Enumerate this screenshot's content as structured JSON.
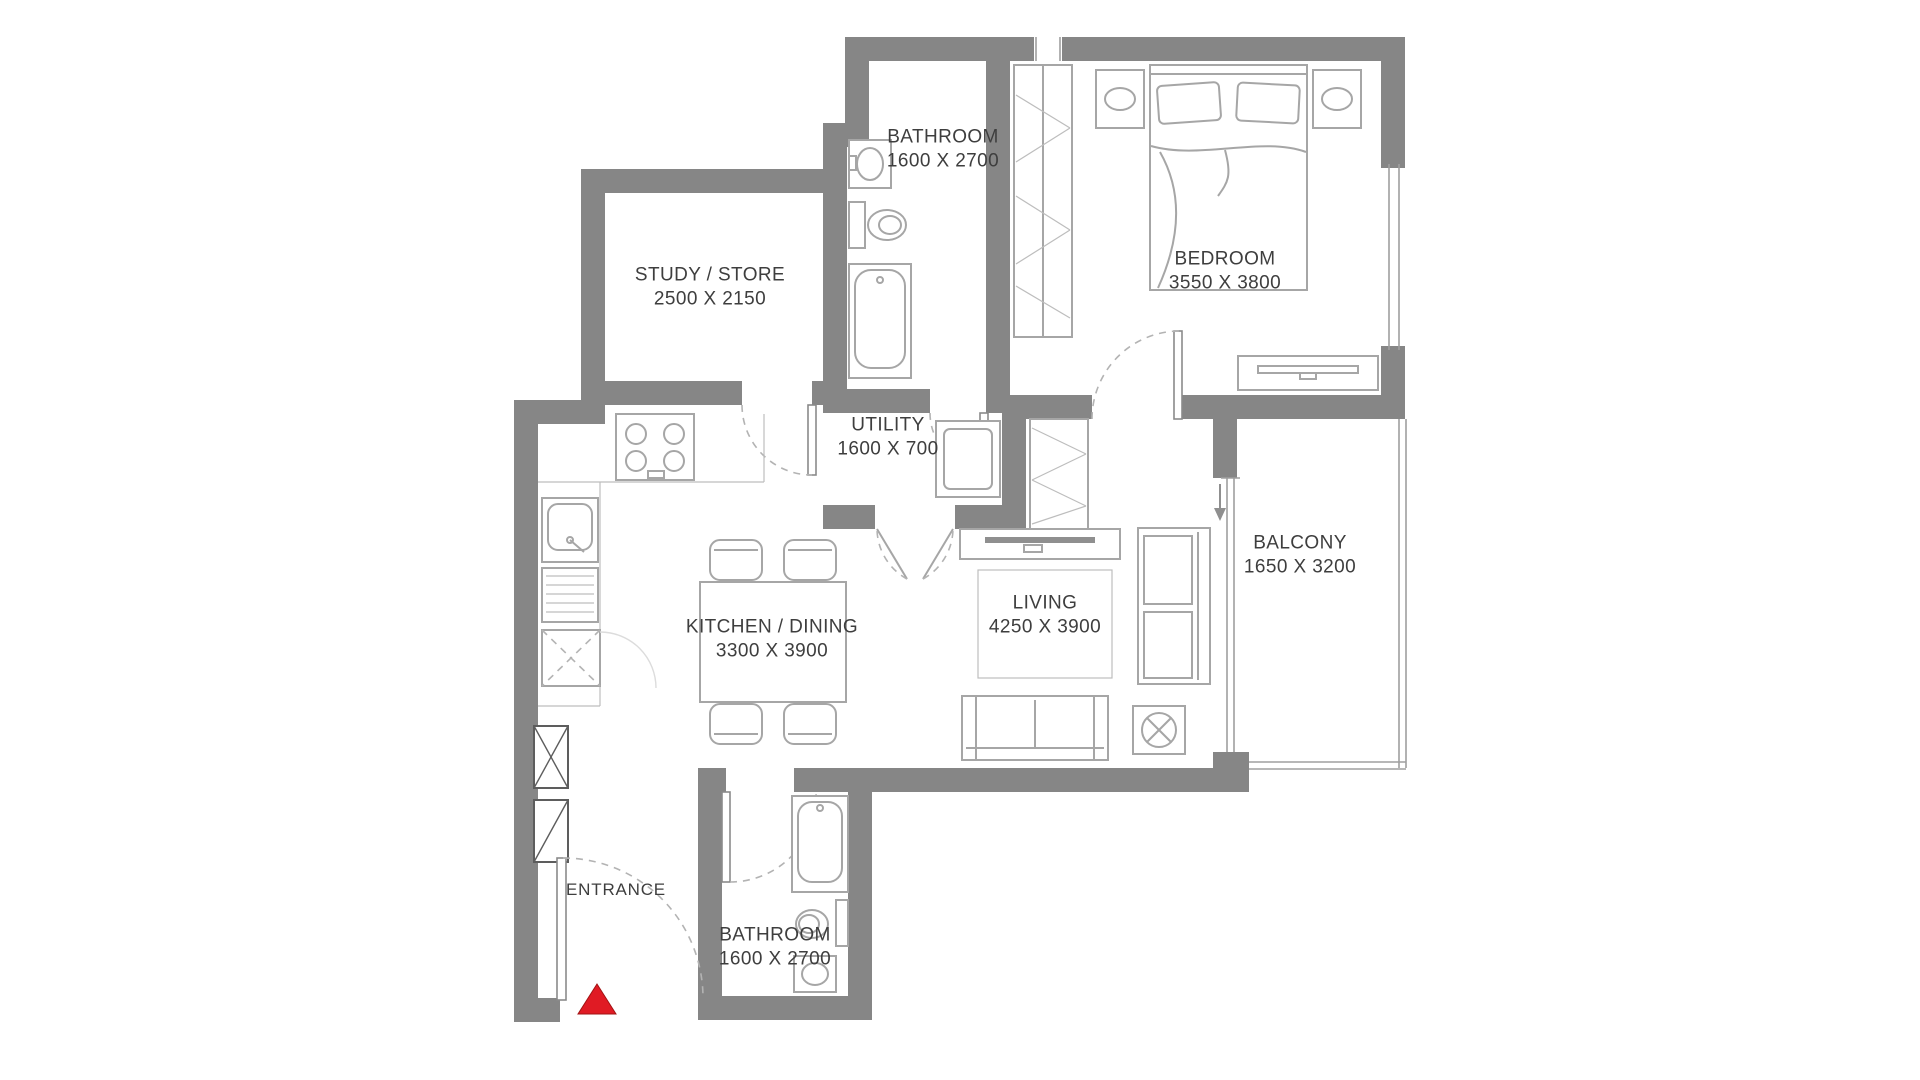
{
  "plan": {
    "type": "apartment-floor-plan",
    "rooms": {
      "bathroom_top": {
        "name": "BATHROOM",
        "dims": "1600 X 2700"
      },
      "study": {
        "name": "STUDY / STORE",
        "dims": "2500 X 2150"
      },
      "utility": {
        "name": "UTILITY",
        "dims": "1600 X 700"
      },
      "bedroom": {
        "name": "BEDROOM",
        "dims": "3550 X 3800"
      },
      "kitchen_dining": {
        "name": "KITCHEN / DINING",
        "dims": "3300 X 3900"
      },
      "living": {
        "name": "LIVING",
        "dims": "4250 X 3900"
      },
      "balcony": {
        "name": "BALCONY",
        "dims": "1650 X 3200"
      },
      "entrance": {
        "name": "ENTRANCE",
        "dims": ""
      },
      "bathroom_bottom": {
        "name": "BATHROOM",
        "dims": "1600 X 2700"
      }
    },
    "markers": {
      "entrance_marker": "red-triangle",
      "balcony_entry": "down-arrow"
    },
    "colors": {
      "wall": "#868686",
      "furniture": "#a6a6a6",
      "line": "#9f9f9f",
      "text": "#3e3e3e",
      "entrance_marker": "#e01b24",
      "background": "#ffffff"
    }
  }
}
